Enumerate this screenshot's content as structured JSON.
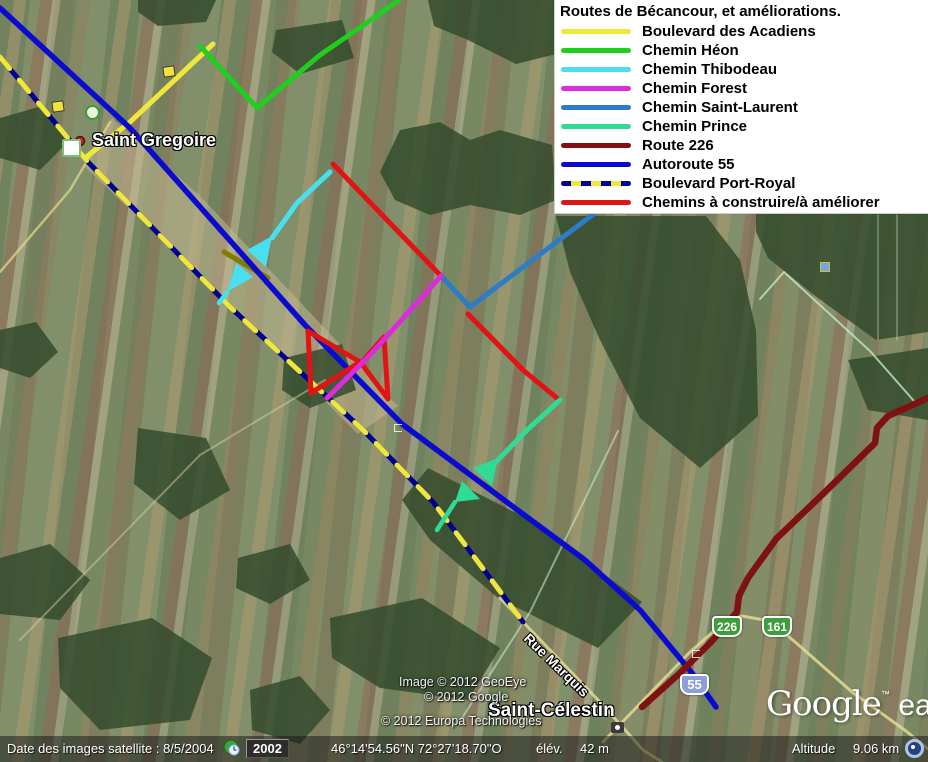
{
  "legend": {
    "title": "Routes de Bécancour, et améliorations.",
    "items": [
      {
        "label": "Boulevard des Acadiens",
        "color": "#EFE73C"
      },
      {
        "label": "Chemin Héon",
        "color": "#1FCE1F"
      },
      {
        "label": "Chemin Thibodeau",
        "color": "#4ADEEE"
      },
      {
        "label": "Chemin Forest",
        "color": "#DB2BDB"
      },
      {
        "label": "Chemin Saint-Laurent",
        "color": "#2D7CC6"
      },
      {
        "label": "Chemin Prince",
        "color": "#2FDC96"
      },
      {
        "label": "Route 226",
        "color": "#7E1212"
      },
      {
        "label": "Autoroute 55",
        "color": "#0B0BD0"
      },
      {
        "label": "Boulevard Port-Royal",
        "color": "#000090",
        "dash_color": "#EFE73C"
      },
      {
        "label": "Chemins à construire/à améliorer",
        "color": "#E01414"
      }
    ]
  },
  "map": {
    "labels": {
      "saint_gregoire": "Saint Gregoire",
      "saint_celestin": "Saint-Célestin",
      "rue_marquis": "Rue Marquis"
    },
    "shields": [
      {
        "label": "226"
      },
      {
        "label": "161"
      },
      {
        "label": "55"
      }
    ],
    "attribution": {
      "line1": "Image © 2012 GeoEye",
      "line2": "© 2012 Google",
      "line3": "© 2012 Europa Technologies"
    },
    "logo": {
      "google": "Google",
      "tm": "™",
      "earth": "earth"
    }
  },
  "status_bar": {
    "date_label": "Date des images satellite : 8/5/2004",
    "year_badge": "2002",
    "coordinates": "46°14'54.56\"N  72°27'18.70\"O",
    "elev_label": "élév.",
    "elev_value": "42 m",
    "altitude_label": "Altitude",
    "altitude_value": "9.06 km"
  }
}
